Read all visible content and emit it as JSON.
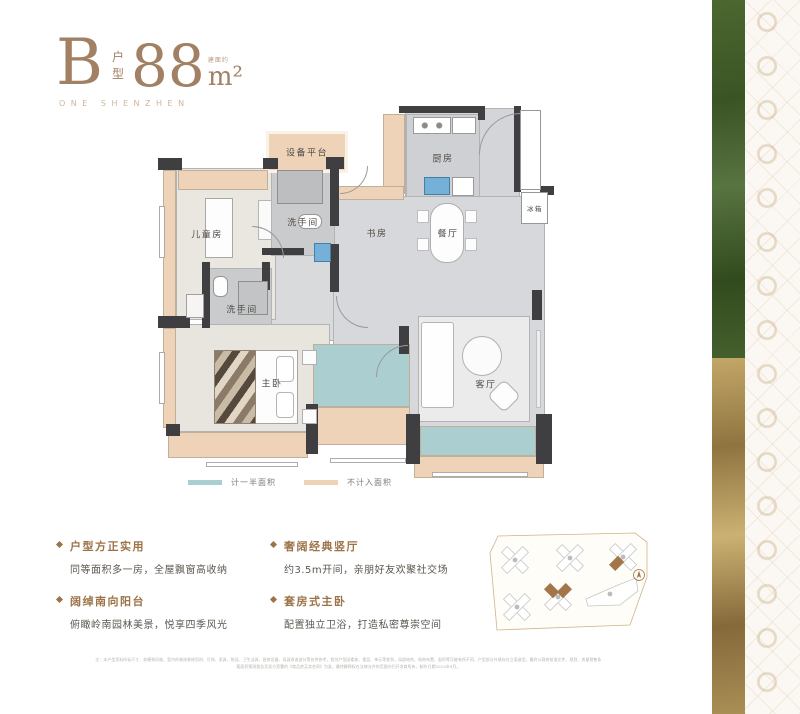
{
  "title": {
    "letter": "B",
    "type_stacked": "户型",
    "area": "88",
    "area_note": "建面约",
    "unit": "m²",
    "brand": "ONE SHENZHEN"
  },
  "legend": {
    "items": [
      {
        "label": "计一半面积",
        "color": "#abced0"
      },
      {
        "label": "不计入面积",
        "color": "#eed3b8"
      }
    ]
  },
  "features": [
    {
      "heading": "户型方正实用",
      "desc": "同等面积多一房，全屋飘窗高收纳"
    },
    {
      "heading": "阔绰南向阳台",
      "desc": "俯瞰岭南园林美景，悦享四季风光"
    },
    {
      "heading": "奢阔经典竖厅",
      "desc": "约3.5m开间，亲朋好友欢聚社交场"
    },
    {
      "heading": "套房式主卧",
      "desc": "配置独立卫浴，打造私密尊崇空间"
    }
  ],
  "disclaimer": {
    "line1": "注：本户型资料所标尺寸、软硬装风格、室内的装饰装修用材、灯饰、家具、陈设、卫生洁具、厨房设备、局部改造部分等仅供参考，相邻户型因楼栋、楼层、单元等差别，局部结构、结构布置、面积等可能有所不同，户型部分外墙存在立面造型，最终以政府批准文件、规划、房屋预售条",
    "line2": "案面积预测报告及双方签署的《商品房买卖合同》为准，最终解释权在法律允许的范围内归开发商所有，制作日期2024年9月。"
  },
  "plan": {
    "floors": [
      {
        "n": "floor-entry",
        "x": 405,
        "y": 108,
        "w": 115,
        "h": 92,
        "f": "#d4d5d8",
        "cls": "marble"
      },
      {
        "n": "floor-kitchen",
        "x": 406,
        "y": 114,
        "w": 74,
        "h": 84,
        "f": "#cfd0d3"
      },
      {
        "n": "floor-hall",
        "x": 333,
        "y": 196,
        "w": 212,
        "h": 232,
        "f": "#d7d8db",
        "cls": "marble"
      },
      {
        "n": "floor-corridor",
        "x": 268,
        "y": 255,
        "w": 66,
        "h": 86,
        "f": "#d9dadc",
        "cls": "marble"
      },
      {
        "n": "floor-living",
        "x": 418,
        "y": 316,
        "w": 112,
        "h": 106,
        "f": "#ebebec"
      },
      {
        "n": "floor-kids",
        "x": 176,
        "y": 168,
        "w": 100,
        "h": 152,
        "f": "#eae7e1"
      },
      {
        "n": "floor-bath-top",
        "x": 271,
        "y": 164,
        "w": 64,
        "h": 92,
        "f": "#c9cbcd"
      },
      {
        "n": "floor-bath-master",
        "x": 206,
        "y": 268,
        "w": 66,
        "h": 60,
        "f": "#c9cbcd"
      },
      {
        "n": "floor-master",
        "x": 170,
        "y": 324,
        "w": 160,
        "h": 108,
        "f": "#e8e4de"
      }
    ],
    "accents": [
      {
        "n": "equipment-platform",
        "x": 266,
        "y": 131,
        "w": 82,
        "h": 42,
        "f": "#eed3b8",
        "b": "3px solid #f9f2e7"
      },
      {
        "n": "bay-kids-top",
        "x": 178,
        "y": 170,
        "w": 90,
        "h": 20,
        "f": "#eed3b8"
      },
      {
        "n": "bay-left-upper",
        "x": 163,
        "y": 170,
        "w": 13,
        "h": 148,
        "f": "#eed3b8"
      },
      {
        "n": "bay-left-lower",
        "x": 163,
        "y": 328,
        "w": 13,
        "h": 100,
        "f": "#eed3b8"
      },
      {
        "n": "bay-master-bottom",
        "x": 168,
        "y": 432,
        "w": 140,
        "h": 26,
        "f": "#eed3b8"
      },
      {
        "n": "kitchen-cabinet",
        "x": 383,
        "y": 114,
        "w": 22,
        "h": 80,
        "f": "#eed3b8"
      },
      {
        "n": "bay-corridor",
        "x": 336,
        "y": 186,
        "w": 68,
        "h": 14,
        "f": "#eed3b8"
      },
      {
        "n": "balcony-mid-tan",
        "x": 313,
        "y": 407,
        "w": 97,
        "h": 38,
        "f": "#eed3b8"
      },
      {
        "n": "balcony-right-tan",
        "x": 414,
        "y": 456,
        "w": 130,
        "h": 22,
        "f": "#eed3b8"
      },
      {
        "n": "balcony-mid-teal",
        "x": 313,
        "y": 344,
        "w": 97,
        "h": 63,
        "f": "#abced0"
      },
      {
        "n": "balcony-right-teal",
        "x": 420,
        "y": 426,
        "w": 116,
        "h": 30,
        "f": "#abced0"
      }
    ],
    "walls": [
      {
        "x": 399,
        "y": 106,
        "w": 84,
        "h": 7
      },
      {
        "x": 478,
        "y": 106,
        "w": 7,
        "h": 14
      },
      {
        "x": 263,
        "y": 158,
        "w": 15,
        "h": 11
      },
      {
        "x": 326,
        "y": 157,
        "w": 18,
        "h": 12
      },
      {
        "x": 330,
        "y": 168,
        "w": 9,
        "h": 58
      },
      {
        "x": 330,
        "y": 244,
        "w": 9,
        "h": 48
      },
      {
        "x": 262,
        "y": 248,
        "w": 42,
        "h": 7
      },
      {
        "x": 202,
        "y": 262,
        "w": 8,
        "h": 66
      },
      {
        "x": 262,
        "y": 262,
        "w": 8,
        "h": 28
      },
      {
        "x": 158,
        "y": 158,
        "w": 24,
        "h": 12
      },
      {
        "x": 158,
        "y": 316,
        "w": 32,
        "h": 12
      },
      {
        "x": 514,
        "y": 106,
        "w": 7,
        "h": 86
      },
      {
        "x": 540,
        "y": 186,
        "w": 14,
        "h": 9
      },
      {
        "x": 306,
        "y": 404,
        "w": 12,
        "h": 50
      },
      {
        "x": 399,
        "y": 326,
        "w": 10,
        "h": 28
      },
      {
        "x": 406,
        "y": 414,
        "w": 14,
        "h": 50
      },
      {
        "x": 536,
        "y": 414,
        "w": 16,
        "h": 50
      },
      {
        "x": 532,
        "y": 290,
        "w": 10,
        "h": 30
      },
      {
        "x": 166,
        "y": 424,
        "w": 14,
        "h": 12
      }
    ],
    "furniture": [
      {
        "n": "dining-table",
        "x": 430,
        "y": 203,
        "w": 34,
        "h": 60,
        "f": "#fdfdfd",
        "b": "1px solid #aeaeae",
        "r": 16
      },
      {
        "n": "chair",
        "x": 417,
        "y": 210,
        "w": 12,
        "h": 13,
        "f": "#fdfdfd",
        "b": "1px solid #bdbdbd"
      },
      {
        "n": "chair",
        "x": 417,
        "y": 238,
        "w": 12,
        "h": 13,
        "f": "#fdfdfd",
        "b": "1px solid #bdbdbd"
      },
      {
        "n": "chair",
        "x": 465,
        "y": 210,
        "w": 12,
        "h": 13,
        "f": "#fdfdfd",
        "b": "1px solid #bdbdbd"
      },
      {
        "n": "chair",
        "x": 465,
        "y": 238,
        "w": 12,
        "h": 13,
        "f": "#fdfdfd",
        "b": "1px solid #bdbdbd"
      },
      {
        "n": "sofa",
        "x": 421,
        "y": 322,
        "w": 33,
        "h": 86,
        "f": "#fefefe",
        "b": "1px solid #b5b5b5",
        "r": 3
      },
      {
        "n": "coffee-table",
        "x": 462,
        "y": 336,
        "w": 40,
        "h": 40,
        "f": "#fbfbfb",
        "b": "1px solid #b0b0b0",
        "r": 20
      },
      {
        "n": "armchair",
        "x": 492,
        "y": 384,
        "w": 24,
        "h": 24,
        "f": "#fdfdfd",
        "b": "1px solid #b0b0b0",
        "r": 6,
        "rot": 45
      },
      {
        "n": "tv-bench",
        "x": 536,
        "y": 330,
        "w": 5,
        "h": 78,
        "f": "#ededed",
        "b": "1px solid #c0c0c0"
      },
      {
        "n": "bed-master",
        "x": 214,
        "y": 350,
        "w": 84,
        "h": 74,
        "f": "#fdfdfd",
        "b": "1px solid #a5a5a5"
      },
      {
        "n": "bed-blanket",
        "x": 214,
        "y": 350,
        "w": 42,
        "h": 74,
        "cls": "blanket"
      },
      {
        "n": "pillow",
        "x": 276,
        "y": 356,
        "w": 18,
        "h": 26,
        "f": "#ffffff",
        "b": "1px solid #b5b5b5",
        "r": 4
      },
      {
        "n": "pillow",
        "x": 276,
        "y": 392,
        "w": 18,
        "h": 26,
        "f": "#ffffff",
        "b": "1px solid #b5b5b5",
        "r": 4
      },
      {
        "n": "nightstand",
        "x": 302,
        "y": 350,
        "w": 15,
        "h": 15,
        "f": "#fcfcfc",
        "b": "1px solid #b0b0b0"
      },
      {
        "n": "nightstand",
        "x": 302,
        "y": 409,
        "w": 15,
        "h": 15,
        "f": "#fcfcfc",
        "b": "1px solid #b0b0b0"
      },
      {
        "n": "bed-kids",
        "x": 205,
        "y": 198,
        "w": 28,
        "h": 60,
        "f": "#fdfdfd",
        "b": "1px solid #a8a8a8"
      },
      {
        "n": "desk-kids",
        "x": 258,
        "y": 200,
        "w": 14,
        "h": 40,
        "f": "#fafafa",
        "b": "1px solid #b5b5b5"
      },
      {
        "n": "shower-top",
        "x": 277,
        "y": 170,
        "w": 46,
        "h": 34,
        "f": "#bcbec0",
        "b": "1px solid #8e8e8e"
      },
      {
        "n": "toilet-top",
        "x": 298,
        "y": 214,
        "w": 24,
        "h": 15,
        "f": "#fefefe",
        "b": "1px solid #969696",
        "r": 7
      },
      {
        "n": "basin-blue",
        "x": 314,
        "y": 243,
        "w": 17,
        "h": 19,
        "f": "#74b0d8",
        "b": "1px solid #477ea6"
      },
      {
        "n": "toilet-master",
        "x": 213,
        "y": 276,
        "w": 15,
        "h": 21,
        "f": "#fefefe",
        "b": "1px solid #969696",
        "r": 6
      },
      {
        "n": "shower-master",
        "x": 238,
        "y": 281,
        "w": 30,
        "h": 34,
        "f": "#c2c4c6",
        "b": "1px solid #8e8e8e"
      },
      {
        "n": "stove",
        "x": 413,
        "y": 117,
        "w": 38,
        "h": 17,
        "cls": "stove",
        "b": "1px solid #9a9a9a"
      },
      {
        "n": "counter",
        "x": 452,
        "y": 117,
        "w": 24,
        "h": 17,
        "f": "#ffffff",
        "b": "1px solid #9a9a9a"
      },
      {
        "n": "sink-kitchen",
        "x": 424,
        "y": 177,
        "w": 26,
        "h": 18,
        "f": "#74b0d8",
        "b": "1px solid #477ea6"
      },
      {
        "n": "counter-x",
        "x": 452,
        "y": 177,
        "w": 22,
        "h": 19,
        "cls": "xbox",
        "f": "#ffffff",
        "b": "1px solid #9a9a9a"
      },
      {
        "n": "shaft",
        "x": 520,
        "y": 110,
        "w": 21,
        "h": 80,
        "cls": "xbox",
        "f": "#ffffff",
        "b": "1px solid #979797"
      },
      {
        "n": "fridge-box",
        "x": 521,
        "y": 192,
        "w": 27,
        "h": 32,
        "cls": "xbox",
        "f": "#ffffff",
        "b": "1px solid #979797"
      },
      {
        "n": "washer",
        "x": 186,
        "y": 294,
        "w": 18,
        "h": 24,
        "f": "#f6f5f3",
        "b": "1px solid #a0a0a0"
      },
      {
        "n": "window",
        "x": 159,
        "y": 206,
        "w": 6,
        "h": 52,
        "f": "#ffffff",
        "b": "1px solid #ababab"
      },
      {
        "n": "window",
        "x": 159,
        "y": 352,
        "w": 6,
        "h": 52,
        "f": "#ffffff",
        "b": "1px solid #ababab"
      },
      {
        "n": "window",
        "x": 330,
        "y": 458,
        "w": 76,
        "h": 5,
        "f": "#ffffff",
        "b": "1px solid #ababab"
      },
      {
        "n": "window",
        "x": 432,
        "y": 472,
        "w": 96,
        "h": 5,
        "f": "#ffffff",
        "b": "1px solid #ababab"
      },
      {
        "n": "window",
        "x": 206,
        "y": 462,
        "w": 92,
        "h": 5,
        "f": "#ffffff",
        "b": "1px solid #ababab"
      }
    ],
    "arcs": [
      {
        "n": "door-arc",
        "x": 479,
        "y": 113,
        "w": 42,
        "h": 42,
        "rot": 90
      },
      {
        "n": "door-arc",
        "x": 252,
        "y": 226,
        "w": 32,
        "h": 32,
        "rot": 180
      },
      {
        "n": "door-arc",
        "x": 336,
        "y": 296,
        "w": 32,
        "h": 32,
        "rot": 0
      },
      {
        "n": "door-arc",
        "x": 340,
        "y": 166,
        "w": 28,
        "h": 28,
        "rot": 270
      },
      {
        "n": "door-arc",
        "x": 376,
        "y": 345,
        "w": 32,
        "h": 32,
        "rot": 90
      }
    ],
    "labels": [
      {
        "t": "设备平台",
        "x": 307,
        "y": 152,
        "s": 9
      },
      {
        "t": "洗手间",
        "x": 303,
        "y": 222,
        "s": 9
      },
      {
        "t": "儿童房",
        "x": 207,
        "y": 234,
        "s": 9
      },
      {
        "t": "书房",
        "x": 377,
        "y": 233,
        "s": 9
      },
      {
        "t": "厨房",
        "x": 443,
        "y": 158,
        "s": 9
      },
      {
        "t": "餐厅",
        "x": 448,
        "y": 233,
        "s": 9
      },
      {
        "t": "冰箱",
        "x": 535,
        "y": 208,
        "s": 6.5
      },
      {
        "t": "洗手间",
        "x": 242,
        "y": 309,
        "s": 9
      },
      {
        "t": "主卧",
        "x": 272,
        "y": 383,
        "s": 9
      },
      {
        "t": "客厅",
        "x": 486,
        "y": 384,
        "s": 9
      }
    ]
  }
}
